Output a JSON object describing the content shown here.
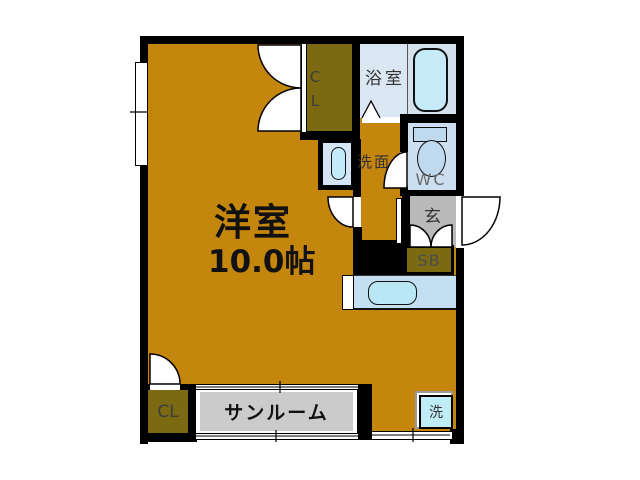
{
  "plan": {
    "type": "apartment-floor-plan",
    "rooms": {
      "main": {
        "label": "洋室",
        "size": "10.0帖"
      },
      "bath": {
        "label": "浴室"
      },
      "vanity": {
        "label": "洗面"
      },
      "wc": {
        "label": "WC"
      },
      "entrance": {
        "label": "玄"
      },
      "shoe_box": {
        "label": "SB"
      },
      "closet_top": {
        "label": "CL"
      },
      "closet_bottom": {
        "label": "CL"
      },
      "sunroom": {
        "label": "サンルーム"
      },
      "washer": {
        "label": "洗"
      }
    },
    "colors": {
      "floor_main": "#C5860D",
      "closet": "#7C6A12",
      "entrance_gray": "#B9B9B9",
      "sunroom_gray": "#CBCBCB",
      "bath_blue": "#DAE6F2",
      "fixture_cyan": "#C6EBF8",
      "wc_blue": "#CBDFF0",
      "kitchen_blue": "#C4DEF2",
      "wall": "#000000",
      "background": "#FFFFFF"
    }
  }
}
